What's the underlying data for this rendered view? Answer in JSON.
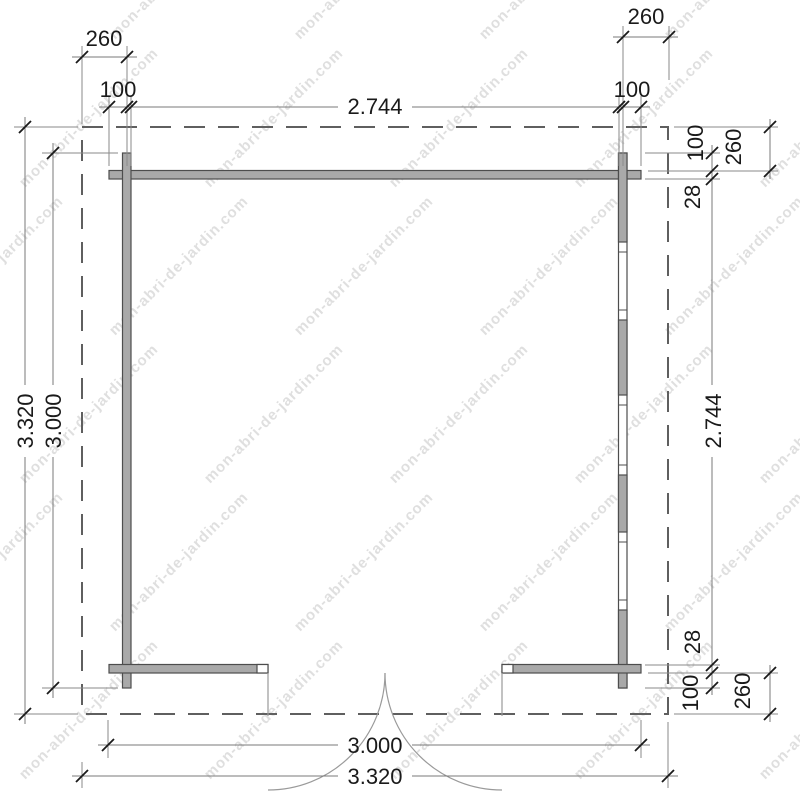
{
  "watermark": {
    "text": "mon-abri-de-jardin.com"
  },
  "dimensions": {
    "top": {
      "overhang_left": "260",
      "log_left": "100",
      "inner_width": "2.744",
      "log_right": "100",
      "overhang_right": "260"
    },
    "left": {
      "total_depth": "3.320",
      "wall_depth": "3.000"
    },
    "right": {
      "log_top": "100",
      "overhang_top": "260",
      "wall_thickness_top": "28",
      "inner_depth": "2.744",
      "wall_thickness_bottom": "28",
      "log_bottom": "100",
      "overhang_bottom": "260"
    },
    "bottom": {
      "wall_width": "3.000",
      "total_width": "3.320"
    }
  },
  "colors": {
    "wall_fill": "#a9a9a9",
    "wall_stroke": "#4d4d4d",
    "dashed_outline": "#5f5f5f",
    "dimension_line": "#7a7a7a",
    "text": "#1a1a1a",
    "watermark": "#c6c6c6"
  }
}
